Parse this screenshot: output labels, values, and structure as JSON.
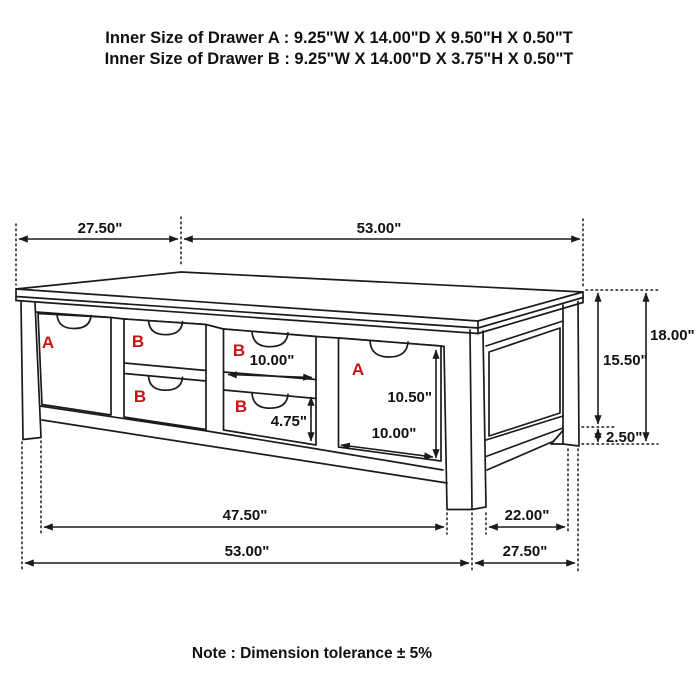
{
  "title": {
    "line1": "Inner Size of Drawer A : 9.25\"W X 14.00\"D X 9.50\"H X 0.50\"T",
    "line2": "Inner Size of Drawer B : 9.25\"W X 14.00\"D X 3.75\"H X 0.50\"T"
  },
  "note": "Note : Dimension tolerance ± 5%",
  "colors": {
    "line": "#1b1b1b",
    "drawer_label": "#c81414"
  },
  "drawer_labels": {
    "a": "A",
    "b": "B"
  },
  "dimensions": {
    "top_depth": "27.50\"",
    "top_width": "53.00\"",
    "total_height": "18.00\"",
    "height_to_stretcher": "15.50\"",
    "foot_clearance": "2.50\"",
    "drawer_b_width": "10.00\"",
    "drawer_b_height": "4.75\"",
    "drawer_a_height": "10.50\"",
    "drawer_a_width": "10.00\"",
    "leg_inner_span": "47.50\"",
    "base_width": "53.00\"",
    "side_inner_span": "22.00\"",
    "base_depth": "27.50\""
  }
}
